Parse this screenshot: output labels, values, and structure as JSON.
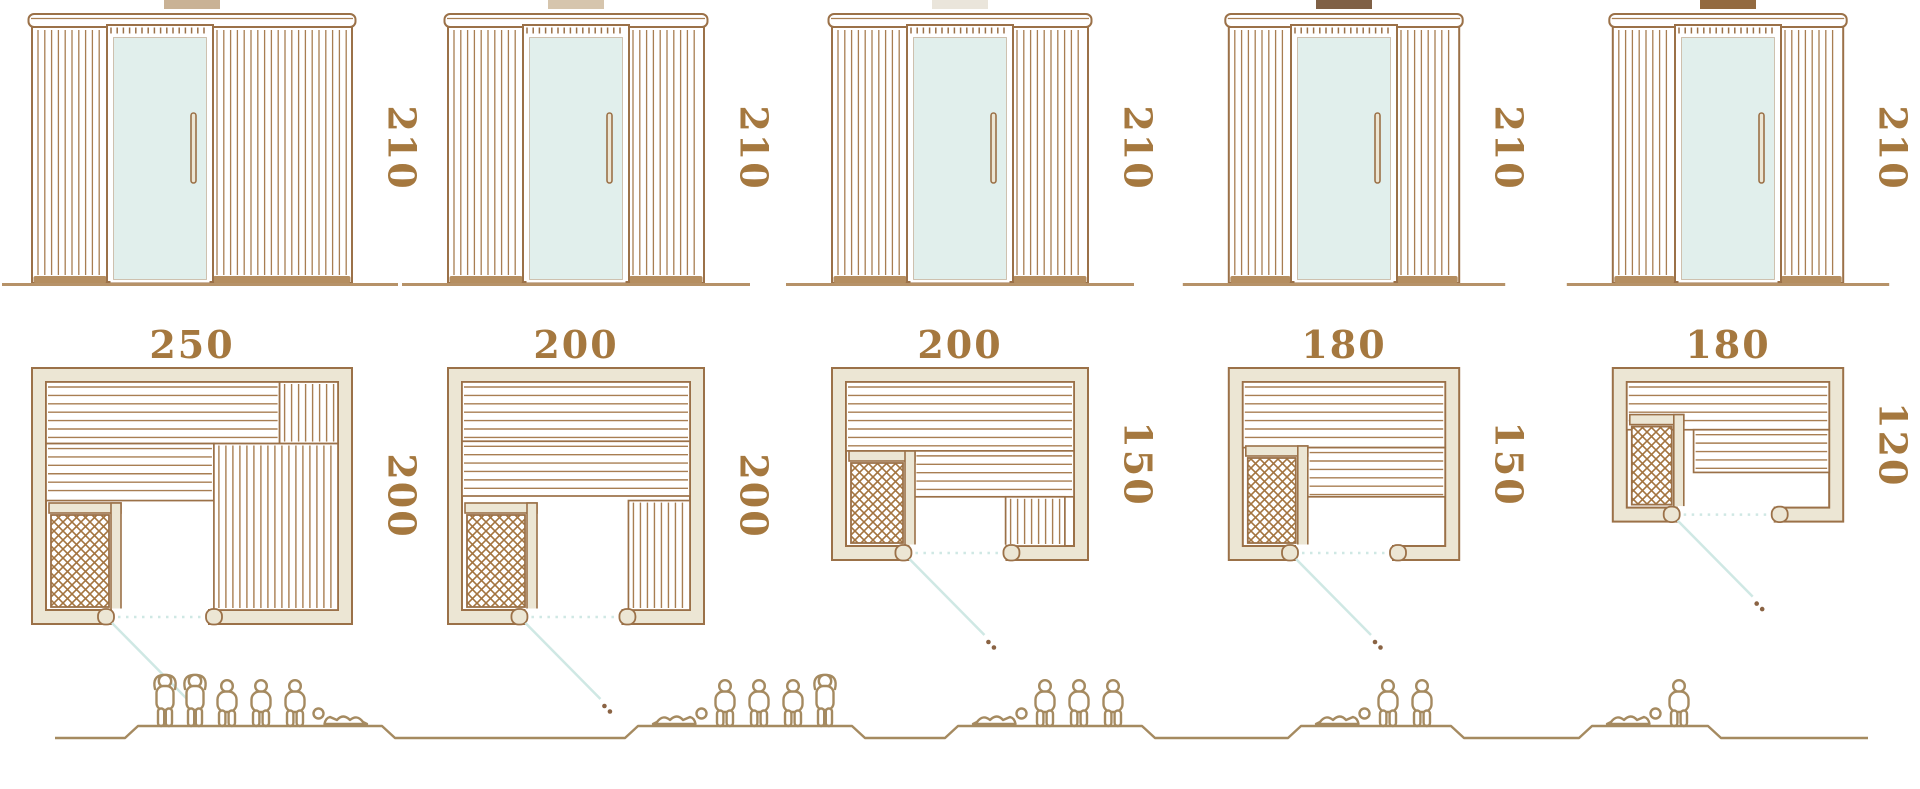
{
  "diagram": {
    "type": "sauna-model-size-comparison",
    "units_shown": "none",
    "colors": {
      "line": "#9b7148",
      "slat": "#a87e52",
      "wall_fill": "#ece6d4",
      "glass": "#e1efec",
      "dimension_text": "#a5783f",
      "swing_line": "#cfe8e4",
      "dotted_line": "#cfe8e4",
      "figure_line": "#a58a60",
      "ground": "#b69268",
      "base_dark": "#b58e60",
      "bench_band": "#c9ad84",
      "heater_hatch": "#a3743f",
      "handle_dot": "#8a6343"
    },
    "models": [
      {
        "id": "sauna-250x200",
        "swatch_color": "#c9b295",
        "elevation": {
          "width_cm": 250,
          "height_cm": 210,
          "height_label": "210"
        },
        "plan": {
          "width_cm": 250,
          "depth_cm": 200,
          "width_label": "250",
          "depth_label": "200",
          "layout": "l-shaped-benches-right",
          "door_position": "left-of-center",
          "heater_position": "front-left"
        },
        "capacity": {
          "total": 6,
          "figures": [
            "standing",
            "standing",
            "sitting",
            "sitting",
            "sitting",
            "lying"
          ]
        }
      },
      {
        "id": "sauna-200x200",
        "swatch_color": "#d6c5ad",
        "elevation": {
          "width_cm": 200,
          "height_cm": 210,
          "height_label": "210"
        },
        "plan": {
          "width_cm": 200,
          "depth_cm": 200,
          "width_label": "200",
          "depth_label": "200",
          "layout": "full-width-bench-plus-front-right-bench",
          "door_position": "center",
          "heater_position": "front-left"
        },
        "capacity": {
          "total": 5,
          "figures": [
            "lying",
            "sitting",
            "sitting",
            "sitting",
            "standing"
          ]
        }
      },
      {
        "id": "sauna-200x150",
        "swatch_color": "#eae5db",
        "elevation": {
          "width_cm": 200,
          "height_cm": 210,
          "height_label": "210"
        },
        "plan": {
          "width_cm": 200,
          "depth_cm": 150,
          "width_label": "200",
          "depth_label": "150",
          "layout": "full-width-bench-plus-front-right-bench",
          "door_position": "center",
          "heater_position": "front-left"
        },
        "capacity": {
          "total": 4,
          "figures": [
            "lying",
            "sitting",
            "sitting",
            "sitting"
          ]
        }
      },
      {
        "id": "sauna-180x150",
        "swatch_color": "#7f6045",
        "elevation": {
          "width_cm": 180,
          "height_cm": 210,
          "height_label": "210"
        },
        "plan": {
          "width_cm": 180,
          "depth_cm": 150,
          "width_label": "180",
          "depth_label": "150",
          "layout": "two-tier-back-bench",
          "door_position": "center",
          "heater_position": "front-left"
        },
        "capacity": {
          "total": 3,
          "figures": [
            "lying",
            "sitting",
            "sitting"
          ]
        }
      },
      {
        "id": "sauna-180x120",
        "swatch_color": "#936a40",
        "elevation": {
          "width_cm": 180,
          "height_cm": 210,
          "height_label": "210"
        },
        "plan": {
          "width_cm": 180,
          "depth_cm": 120,
          "width_label": "180",
          "depth_label": "120",
          "layout": "two-tier-back-bench",
          "door_position": "center",
          "heater_position": "front-left"
        },
        "capacity": {
          "total": 2,
          "figures": [
            "lying",
            "sitting"
          ]
        }
      }
    ]
  }
}
